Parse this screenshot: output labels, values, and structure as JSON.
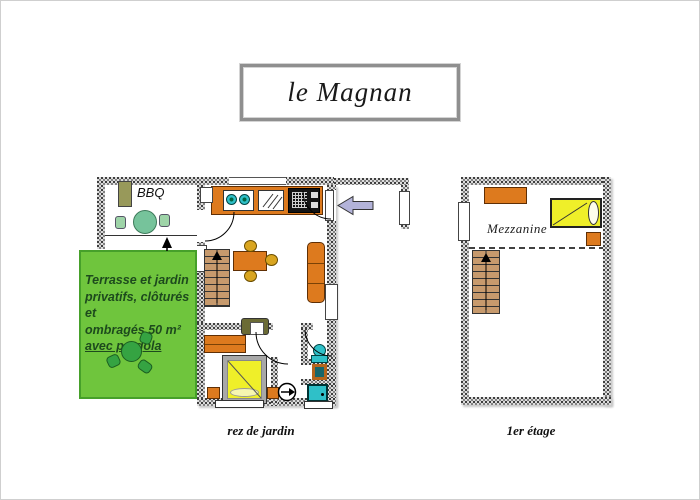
{
  "title": "le Magnan",
  "ground_floor": {
    "caption": "rez de jardin",
    "bbq_label": "BBQ",
    "terrace_text": {
      "line1": "Terrasse et jardin",
      "line2": "privatifs, clôturés et",
      "line3": "ombragés 50 m²",
      "line4_underlined": "avec pergola"
    }
  },
  "first_floor": {
    "caption": "1er étage",
    "mezzanine_label": "Mezzanine"
  },
  "colors": {
    "terrace-green": "#6fc53d",
    "terrace-green-border": "#46a02a",
    "terrace-text": "#1d4a1d",
    "furniture-orange": "#dd7a1e",
    "wood-tan": "#c79a6d",
    "bed-yellow": "#efef29",
    "teal": "#2fc0c8",
    "mustard": "#d9a520",
    "olive": "#98995a",
    "garden-green": "#35a342",
    "terrace-table-green": "#76c39b",
    "terrace-chair-green": "#9ed4a8",
    "arrow-lavender": "#b3b3d9",
    "wall-gray": "#dcdcdc"
  }
}
